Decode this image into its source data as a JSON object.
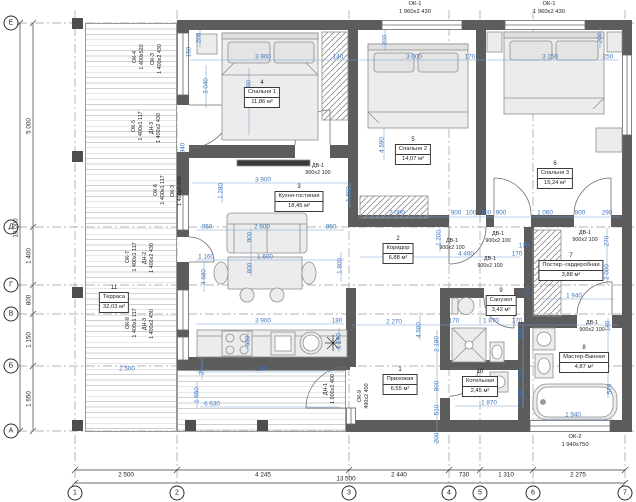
{
  "axes": {
    "cols": [
      "1",
      "2",
      "3",
      "4",
      "5",
      "6",
      "7"
    ],
    "rows": [
      "Е",
      "Д",
      "Г",
      "В",
      "Б",
      "А"
    ]
  },
  "dims": {
    "black": [
      "2 500",
      "4 245",
      "2 440",
      "730",
      "1 310",
      "2 275",
      "13 500",
      "5 000",
      "1 400",
      "800",
      "1 150",
      "1 650",
      "10 000"
    ],
    "blue": [
      "150",
      "200",
      "3 900",
      "140",
      "3 040",
      "2 100",
      "940",
      "200",
      "3 000",
      "170",
      "3 250",
      "250",
      "200",
      "4 690",
      "3 900",
      "1 280",
      "1 690",
      "950",
      "2 600",
      "950",
      "900",
      "1 160",
      "1 600",
      "800",
      "1 800",
      "4 680",
      "2 000",
      "900",
      "100",
      "100",
      "900",
      "1 060",
      "900",
      "290",
      "1 200",
      "4 490",
      "170",
      "170",
      "270",
      "2 000",
      "180",
      "1 940",
      "2 270",
      "4 680",
      "170",
      "1 870",
      "170",
      "830",
      "170",
      "1 330",
      "180",
      "570",
      "1 940",
      "2 180",
      "800",
      "510",
      "200",
      "1 870",
      "3 900",
      "180",
      "600",
      "1 190",
      "250",
      "4 130",
      "1 650",
      "6 630",
      "2 500"
    ]
  },
  "rooms": [
    {
      "num": "1",
      "name": "Прихожая",
      "area": "6,55 м²"
    },
    {
      "num": "2",
      "name": "Коридор",
      "area": "6,88 м²"
    },
    {
      "num": "3",
      "name": "Кухня-гостиная",
      "area": "18,45 м²"
    },
    {
      "num": "4",
      "name": "Спальня 1",
      "area": "11,86 м²"
    },
    {
      "num": "5",
      "name": "Спальня 2",
      "area": "14,07 м²"
    },
    {
      "num": "6",
      "name": "Спальня 3",
      "area": "15,24 м²"
    },
    {
      "num": "7",
      "name": "Постир.-гардеробная",
      "area": "3,88 м²"
    },
    {
      "num": "8",
      "name": "Мастер-Ванная",
      "area": "4,87 м²"
    },
    {
      "num": "9",
      "name": "Санузел",
      "area": "3,42 м²"
    },
    {
      "num": "10",
      "name": "Котельная",
      "area": "2,45 м²"
    },
    {
      "num": "11",
      "name": "Терраса",
      "area": "32,03 м²"
    }
  ],
  "openings": {
    "top": [
      {
        "name": "ОК-1",
        "size": "1 960х2 430"
      },
      {
        "name": "ОК-1",
        "size": "1 960х2 430"
      }
    ],
    "bottom": {
      "name": "ОК-2",
      "size": "1 940х750"
    },
    "left": [
      {
        "name": "ОК-4",
        "size": "1 400х520"
      },
      {
        "name": "ОК-3",
        "size": "1 400х2 430"
      },
      {
        "name": "ОК-5",
        "size": "1 400х1 117"
      },
      {
        "name": "ДН-3",
        "size": "1 400х2 430"
      },
      {
        "name": "ОК-6",
        "size": "1 400х1 117"
      },
      {
        "name": "ОК-3",
        "size": "1 400х2 430"
      },
      {
        "name": "ОК-7",
        "size": "1 400х1 117"
      },
      {
        "name": "ДН-2",
        "size": "1 400х2 430"
      },
      {
        "name": "ОК-8",
        "size": "1 400х1 117"
      },
      {
        "name": "ДН-3",
        "size": "1 400х2 430"
      }
    ],
    "entry": {
      "name": "ДН-1",
      "size": "1 000х2 400"
    },
    "hall_window": {
      "name": "ОК-9",
      "size": "490х2 400"
    },
    "interior_doors": [
      {
        "name": "ДВ-1",
        "size": "900х2 100"
      },
      {
        "name": "ДВ-1",
        "size": "900х2 100"
      },
      {
        "name": "ДВ-1",
        "size": "900х2 100"
      },
      {
        "name": "ДВ-1",
        "size": "900х2 100"
      },
      {
        "name": "ДВ-1",
        "size": "900х2 100"
      },
      {
        "name": "ДВ-1",
        "size": "900х2 100"
      }
    ]
  },
  "colors": {
    "wall": "#5c5c5c",
    "dimension_blue": "#3f78bf",
    "deck_line": "#cfcfcf",
    "furniture_fill": "#ececec"
  }
}
